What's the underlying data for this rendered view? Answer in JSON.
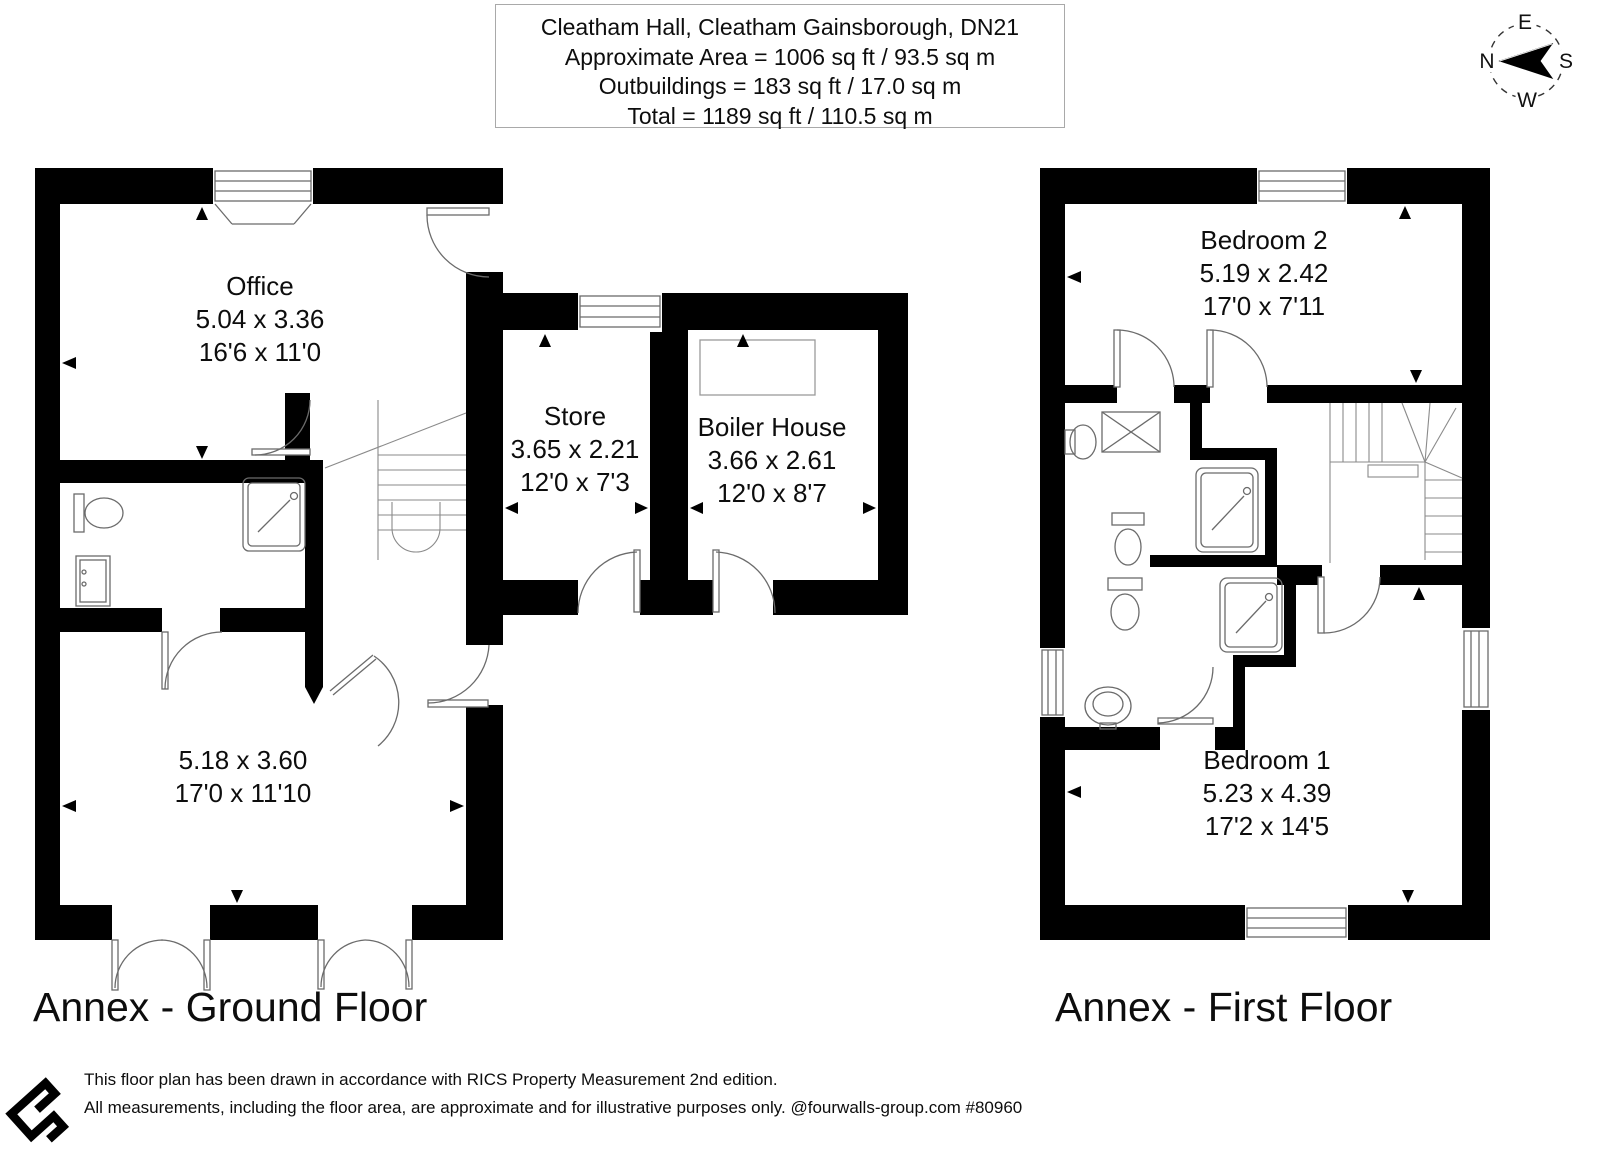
{
  "header": {
    "line1": "Cleatham Hall, Cleatham Gainsborough, DN21",
    "line2": "Approximate Area = 1006 sq ft / 93.5 sq m",
    "line3": "Outbuildings = 183 sq ft / 17.0 sq m",
    "line4": "Total = 1189 sq ft / 110.5 sq m"
  },
  "compass": {
    "n": "N",
    "e": "E",
    "s": "S",
    "w": "W"
  },
  "floors": [
    {
      "name": "Annex - Ground Floor",
      "rooms": [
        {
          "name": "Office",
          "metric": "5.04 x 3.36",
          "imperial": "16'6 x 11'0"
        },
        {
          "name": "Store",
          "metric": "3.65 x 2.21",
          "imperial": "12'0 x 7'3"
        },
        {
          "name": "Boiler House",
          "metric": "3.66 x 2.61",
          "imperial": "12'0 x 8'7"
        },
        {
          "name": "",
          "metric": "5.18 x 3.60",
          "imperial": "17'0 x 11'10"
        }
      ]
    },
    {
      "name": "Annex - First Floor",
      "rooms": [
        {
          "name": "Bedroom 2",
          "metric": "5.19 x 2.42",
          "imperial": "17'0 x 7'11"
        },
        {
          "name": "Bedroom 1",
          "metric": "5.23 x 4.39",
          "imperial": "17'2 x 14'5"
        }
      ]
    }
  ],
  "footer": {
    "line1": "This floor plan has been drawn in accordance with RICS Property Measurement 2nd edition.",
    "line2": "All measurements, including the floor area, are approximate and for illustrative purposes only. @fourwalls-group.com #80960"
  },
  "colors": {
    "wall": "#000000",
    "line": "#6b6b6b",
    "background": "#ffffff"
  }
}
